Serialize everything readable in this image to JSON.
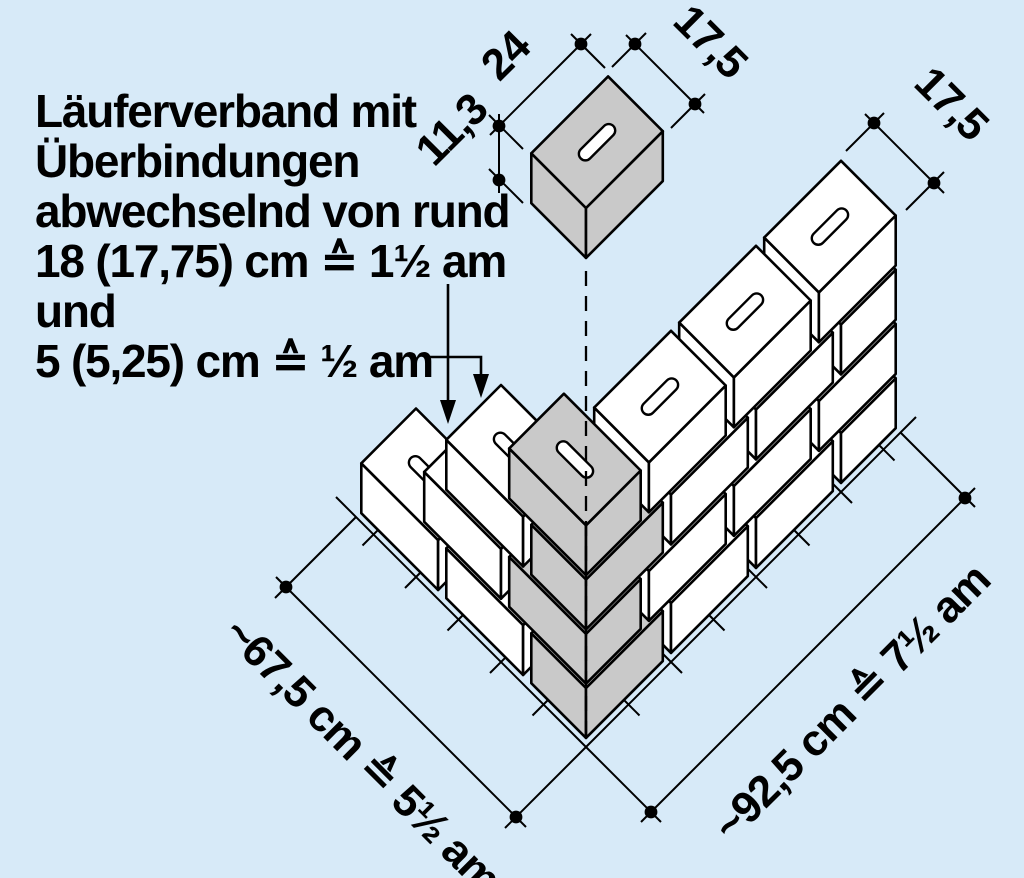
{
  "title_block": {
    "lines": [
      "Läuferverband mit",
      "Überbindungen",
      "abwechselnd von rund",
      "18 (17,75) cm ≙ 1½ am",
      "und",
      "5 (5,25) cm ≙ ½ am"
    ]
  },
  "single_brick": {
    "length_label": "24",
    "width_label": "17,5",
    "height_label": "11,3"
  },
  "wall": {
    "end_width_label": "17,5",
    "left_dimension_label": "~67,5 cm ≙ 5½ am",
    "right_dimension_label": "~92,5 cm ≙ 7½ am",
    "courses": 4
  },
  "colors": {
    "background": "#d7eaf8",
    "brick_face": "#ffffff",
    "corner_brick_face": "#c9c9c9",
    "outline": "#000000"
  },
  "bricks": [
    {
      "course": 1,
      "x": [
        0,
        24
      ],
      "y": [
        0,
        17.5
      ],
      "gray": true
    },
    {
      "course": 1,
      "x": [
        25,
        49
      ],
      "y": [
        0,
        17.5
      ]
    },
    {
      "course": 1,
      "x": [
        50,
        74
      ],
      "y": [
        0,
        17.5
      ]
    },
    {
      "course": 1,
      "x": [
        75,
        92.5
      ],
      "y": [
        0,
        17.5
      ]
    },
    {
      "course": 1,
      "x": [
        0,
        17.5
      ],
      "y": [
        18.5,
        42.5
      ]
    },
    {
      "course": 1,
      "x": [
        0,
        17.5
      ],
      "y": [
        43.5,
        67.5
      ],
      "hole": true
    },
    {
      "course": 2,
      "x": [
        0,
        17.5
      ],
      "y": [
        0,
        24
      ],
      "gray": true
    },
    {
      "course": 2,
      "x": [
        18.5,
        42.5
      ],
      "y": [
        0,
        17.5
      ]
    },
    {
      "course": 2,
      "x": [
        43.5,
        67.5
      ],
      "y": [
        0,
        17.5
      ]
    },
    {
      "course": 2,
      "x": [
        68.5,
        92.5
      ],
      "y": [
        0,
        17.5
      ]
    },
    {
      "course": 2,
      "x": [
        0,
        17.5
      ],
      "y": [
        25,
        49
      ]
    },
    {
      "course": 3,
      "x": [
        0,
        24
      ],
      "y": [
        0,
        17.5
      ],
      "gray": true
    },
    {
      "course": 3,
      "x": [
        25,
        49
      ],
      "y": [
        0,
        17.5
      ]
    },
    {
      "course": 3,
      "x": [
        50,
        74
      ],
      "y": [
        0,
        17.5
      ]
    },
    {
      "course": 3,
      "x": [
        75,
        92.5
      ],
      "y": [
        0,
        17.5
      ]
    },
    {
      "course": 3,
      "x": [
        0,
        17.5
      ],
      "y": [
        18.5,
        42.5
      ],
      "hole": true
    },
    {
      "course": 4,
      "x": [
        0,
        17.5
      ],
      "y": [
        0,
        24
      ],
      "gray": true,
      "hole": true
    },
    {
      "course": 4,
      "x": [
        18.5,
        42.5
      ],
      "y": [
        0,
        17.5
      ],
      "hole": true
    },
    {
      "course": 4,
      "x": [
        43.5,
        67.5
      ],
      "y": [
        0,
        17.5
      ],
      "hole": true
    },
    {
      "course": 4,
      "x": [
        68.5,
        92.5
      ],
      "y": [
        0,
        17.5
      ],
      "hole": true
    },
    {
      "course": 5,
      "x": [
        0,
        24
      ],
      "y": [
        0,
        17.5
      ],
      "gray": true,
      "hole": true,
      "floating": true
    }
  ]
}
